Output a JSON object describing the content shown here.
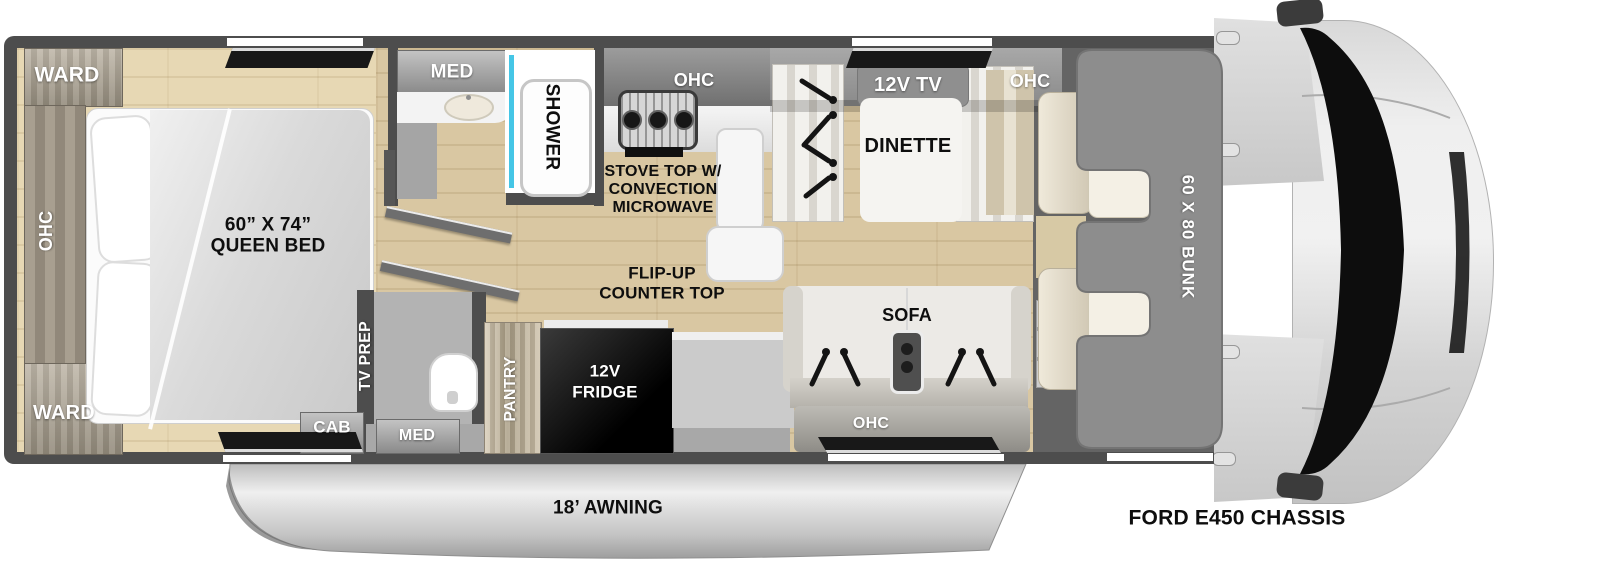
{
  "colors": {
    "wall": "#4d4d4d",
    "floor_wood": "#d9c7a2",
    "bedroom_wood": "#e7d8b4",
    "shower_glass_accent": "#45c6e6",
    "window": "#181818",
    "bunk_overlay": "#8d8d8d",
    "awning_silver": "#c9c9c9"
  },
  "bedroom": {
    "ward_top": "WARD",
    "ohc": "OHC",
    "ward_bottom": "WARD",
    "bed_size": "60” X 74”",
    "bed_type": "QUEEN BED"
  },
  "bath": {
    "med": "MED",
    "shower": "SHOWER"
  },
  "hall": {
    "tv_prep": "TV PREP",
    "cab": "CAB"
  },
  "toilet_room": {
    "med": "MED"
  },
  "kitchen": {
    "ohc": "OHC",
    "stove_line1": "STOVE TOP W/",
    "stove_line2": "CONVECTION",
    "stove_line3": "MICROWAVE",
    "flip_line1": "FLIP-UP",
    "flip_line2": "COUNTER TOP",
    "pantry": "PANTRY",
    "fridge_line1": "12V",
    "fridge_line2": "FRIDGE"
  },
  "dinette": {
    "tv": "12V TV",
    "label": "DINETTE",
    "ohc": "OHC"
  },
  "sofa": {
    "label": "SOFA",
    "ohc": "OHC"
  },
  "cab": {
    "bunk": "60 X 80 BUNK",
    "chassis": "FORD E450 CHASSIS"
  },
  "exterior": {
    "awning": "18’ AWNING"
  }
}
